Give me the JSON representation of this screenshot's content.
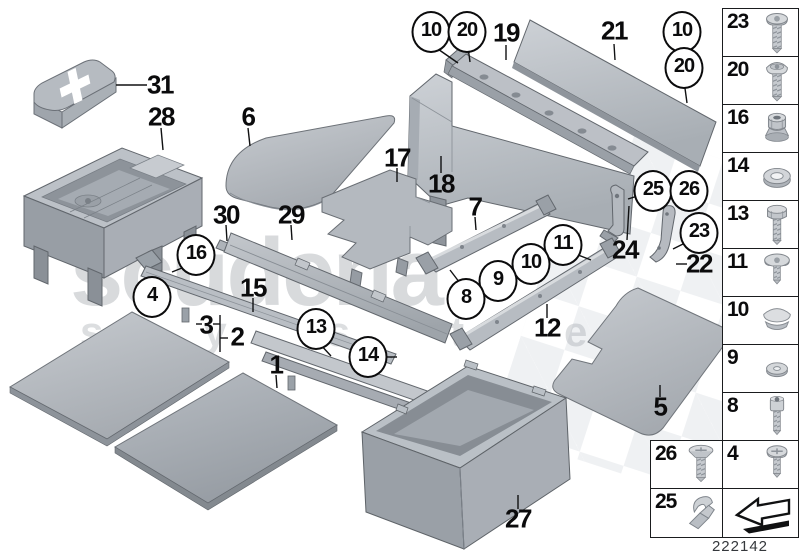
{
  "watermark": {
    "line1": "scuderia",
    "line2": "systems"
  },
  "diagram_number": "222142",
  "colors": {
    "part_gray": "#b4b9bf",
    "outline": "#62676d",
    "watermark_gray": "#8e959c",
    "callout_ink": "#0b0b0c"
  },
  "callouts": [
    {
      "label": "10",
      "circled": true,
      "x": 431,
      "y": 32
    },
    {
      "label": "20",
      "circled": true,
      "x": 467,
      "y": 32
    },
    {
      "label": "19",
      "circled": false,
      "x": 506,
      "y": 33
    },
    {
      "label": "21",
      "circled": false,
      "x": 614,
      "y": 31
    },
    {
      "label": "10",
      "circled": true,
      "x": 682,
      "y": 32
    },
    {
      "label": "20",
      "circled": true,
      "x": 684,
      "y": 68
    },
    {
      "label": "31",
      "circled": false,
      "x": 160,
      "y": 85
    },
    {
      "label": "28",
      "circled": false,
      "x": 161,
      "y": 117
    },
    {
      "label": "6",
      "circled": false,
      "x": 248,
      "y": 117
    },
    {
      "label": "17",
      "circled": false,
      "x": 397,
      "y": 158
    },
    {
      "label": "18",
      "circled": false,
      "x": 441,
      "y": 184
    },
    {
      "label": "7",
      "circled": false,
      "x": 475,
      "y": 207
    },
    {
      "label": "30",
      "circled": false,
      "x": 226,
      "y": 215
    },
    {
      "label": "29",
      "circled": false,
      "x": 291,
      "y": 215
    },
    {
      "label": "25",
      "circled": true,
      "x": 653,
      "y": 191
    },
    {
      "label": "26",
      "circled": true,
      "x": 689,
      "y": 191
    },
    {
      "label": "23",
      "circled": true,
      "x": 699,
      "y": 233
    },
    {
      "label": "24",
      "circled": false,
      "x": 625,
      "y": 250
    },
    {
      "label": "22",
      "circled": false,
      "x": 699,
      "y": 264
    },
    {
      "label": "16",
      "circled": true,
      "x": 196,
      "y": 255
    },
    {
      "label": "4",
      "circled": true,
      "x": 152,
      "y": 297
    },
    {
      "label": "15",
      "circled": false,
      "x": 253,
      "y": 288
    },
    {
      "label": "11",
      "circled": true,
      "x": 563,
      "y": 245
    },
    {
      "label": "10",
      "circled": true,
      "x": 531,
      "y": 264
    },
    {
      "label": "9",
      "circled": true,
      "x": 498,
      "y": 281
    },
    {
      "label": "8",
      "circled": true,
      "x": 466,
      "y": 299
    },
    {
      "label": "12",
      "circled": false,
      "x": 547,
      "y": 328
    },
    {
      "label": "13",
      "circled": true,
      "x": 316,
      "y": 329
    },
    {
      "label": "14",
      "circled": true,
      "x": 368,
      "y": 357
    },
    {
      "label": "3",
      "circled": false,
      "x": 206,
      "y": 325
    },
    {
      "label": "2",
      "circled": false,
      "x": 237,
      "y": 337
    },
    {
      "label": "1",
      "circled": false,
      "x": 276,
      "y": 365
    },
    {
      "label": "5",
      "circled": false,
      "x": 660,
      "y": 407
    },
    {
      "label": "27",
      "circled": false,
      "x": 518,
      "y": 519
    }
  ],
  "leader_lines": [
    [
      435,
      47,
      458,
      63
    ],
    [
      468,
      47,
      470,
      62
    ],
    [
      506,
      45,
      506,
      60
    ],
    [
      614,
      44,
      615,
      60
    ],
    [
      684,
      81,
      687,
      103
    ],
    [
      147,
      85,
      116,
      85
    ],
    [
      161,
      128,
      163,
      150
    ],
    [
      248,
      128,
      250,
      146
    ],
    [
      397,
      168,
      397,
      182
    ],
    [
      441,
      173,
      441,
      156
    ],
    [
      475,
      217,
      476,
      230
    ],
    [
      226,
      225,
      227,
      241
    ],
    [
      291,
      225,
      292,
      240
    ],
    [
      187,
      266,
      172,
      272
    ],
    [
      253,
      298,
      253,
      312
    ],
    [
      319,
      343,
      331,
      356
    ],
    [
      384,
      357,
      397,
      357
    ],
    [
      196,
      324,
      202,
      324
    ],
    [
      213,
      324,
      220,
      324
    ],
    [
      220,
      315,
      220,
      352
    ],
    [
      220,
      338,
      228,
      338
    ],
    [
      276,
      375,
      277,
      388
    ],
    [
      463,
      287,
      450,
      270
    ],
    [
      573,
      253,
      591,
      260
    ],
    [
      547,
      318,
      547,
      304
    ],
    [
      627,
      240,
      629,
      206
    ],
    [
      641,
      195,
      628,
      199
    ],
    [
      689,
      241,
      673,
      249
    ],
    [
      687,
      264,
      676,
      264
    ],
    [
      660,
      397,
      660,
      385
    ],
    [
      518,
      509,
      518,
      495
    ]
  ],
  "sidebar": {
    "main_column": [
      {
        "label": "23",
        "icon": "pan-torx-screw"
      },
      {
        "label": "20",
        "icon": "oval-head-screw"
      },
      {
        "label": "16",
        "icon": "flange-nut"
      },
      {
        "label": "14",
        "icon": "washer-large"
      },
      {
        "label": "13",
        "icon": "hex-bolt"
      },
      {
        "label": "11",
        "icon": "washer-head-screw"
      },
      {
        "label": "10",
        "icon": "plug-cap"
      },
      {
        "label": "9",
        "icon": "washer-small"
      },
      {
        "label": "8",
        "icon": "socket-head-screw"
      },
      {
        "label": "4",
        "icon": "pan-phillips-screw"
      },
      {
        "label": "",
        "icon": "direction-arrow"
      }
    ],
    "extra_column": [
      {
        "label": "26",
        "icon": "flat-head-screw"
      },
      {
        "label": "25",
        "icon": "spring-clip"
      }
    ]
  }
}
